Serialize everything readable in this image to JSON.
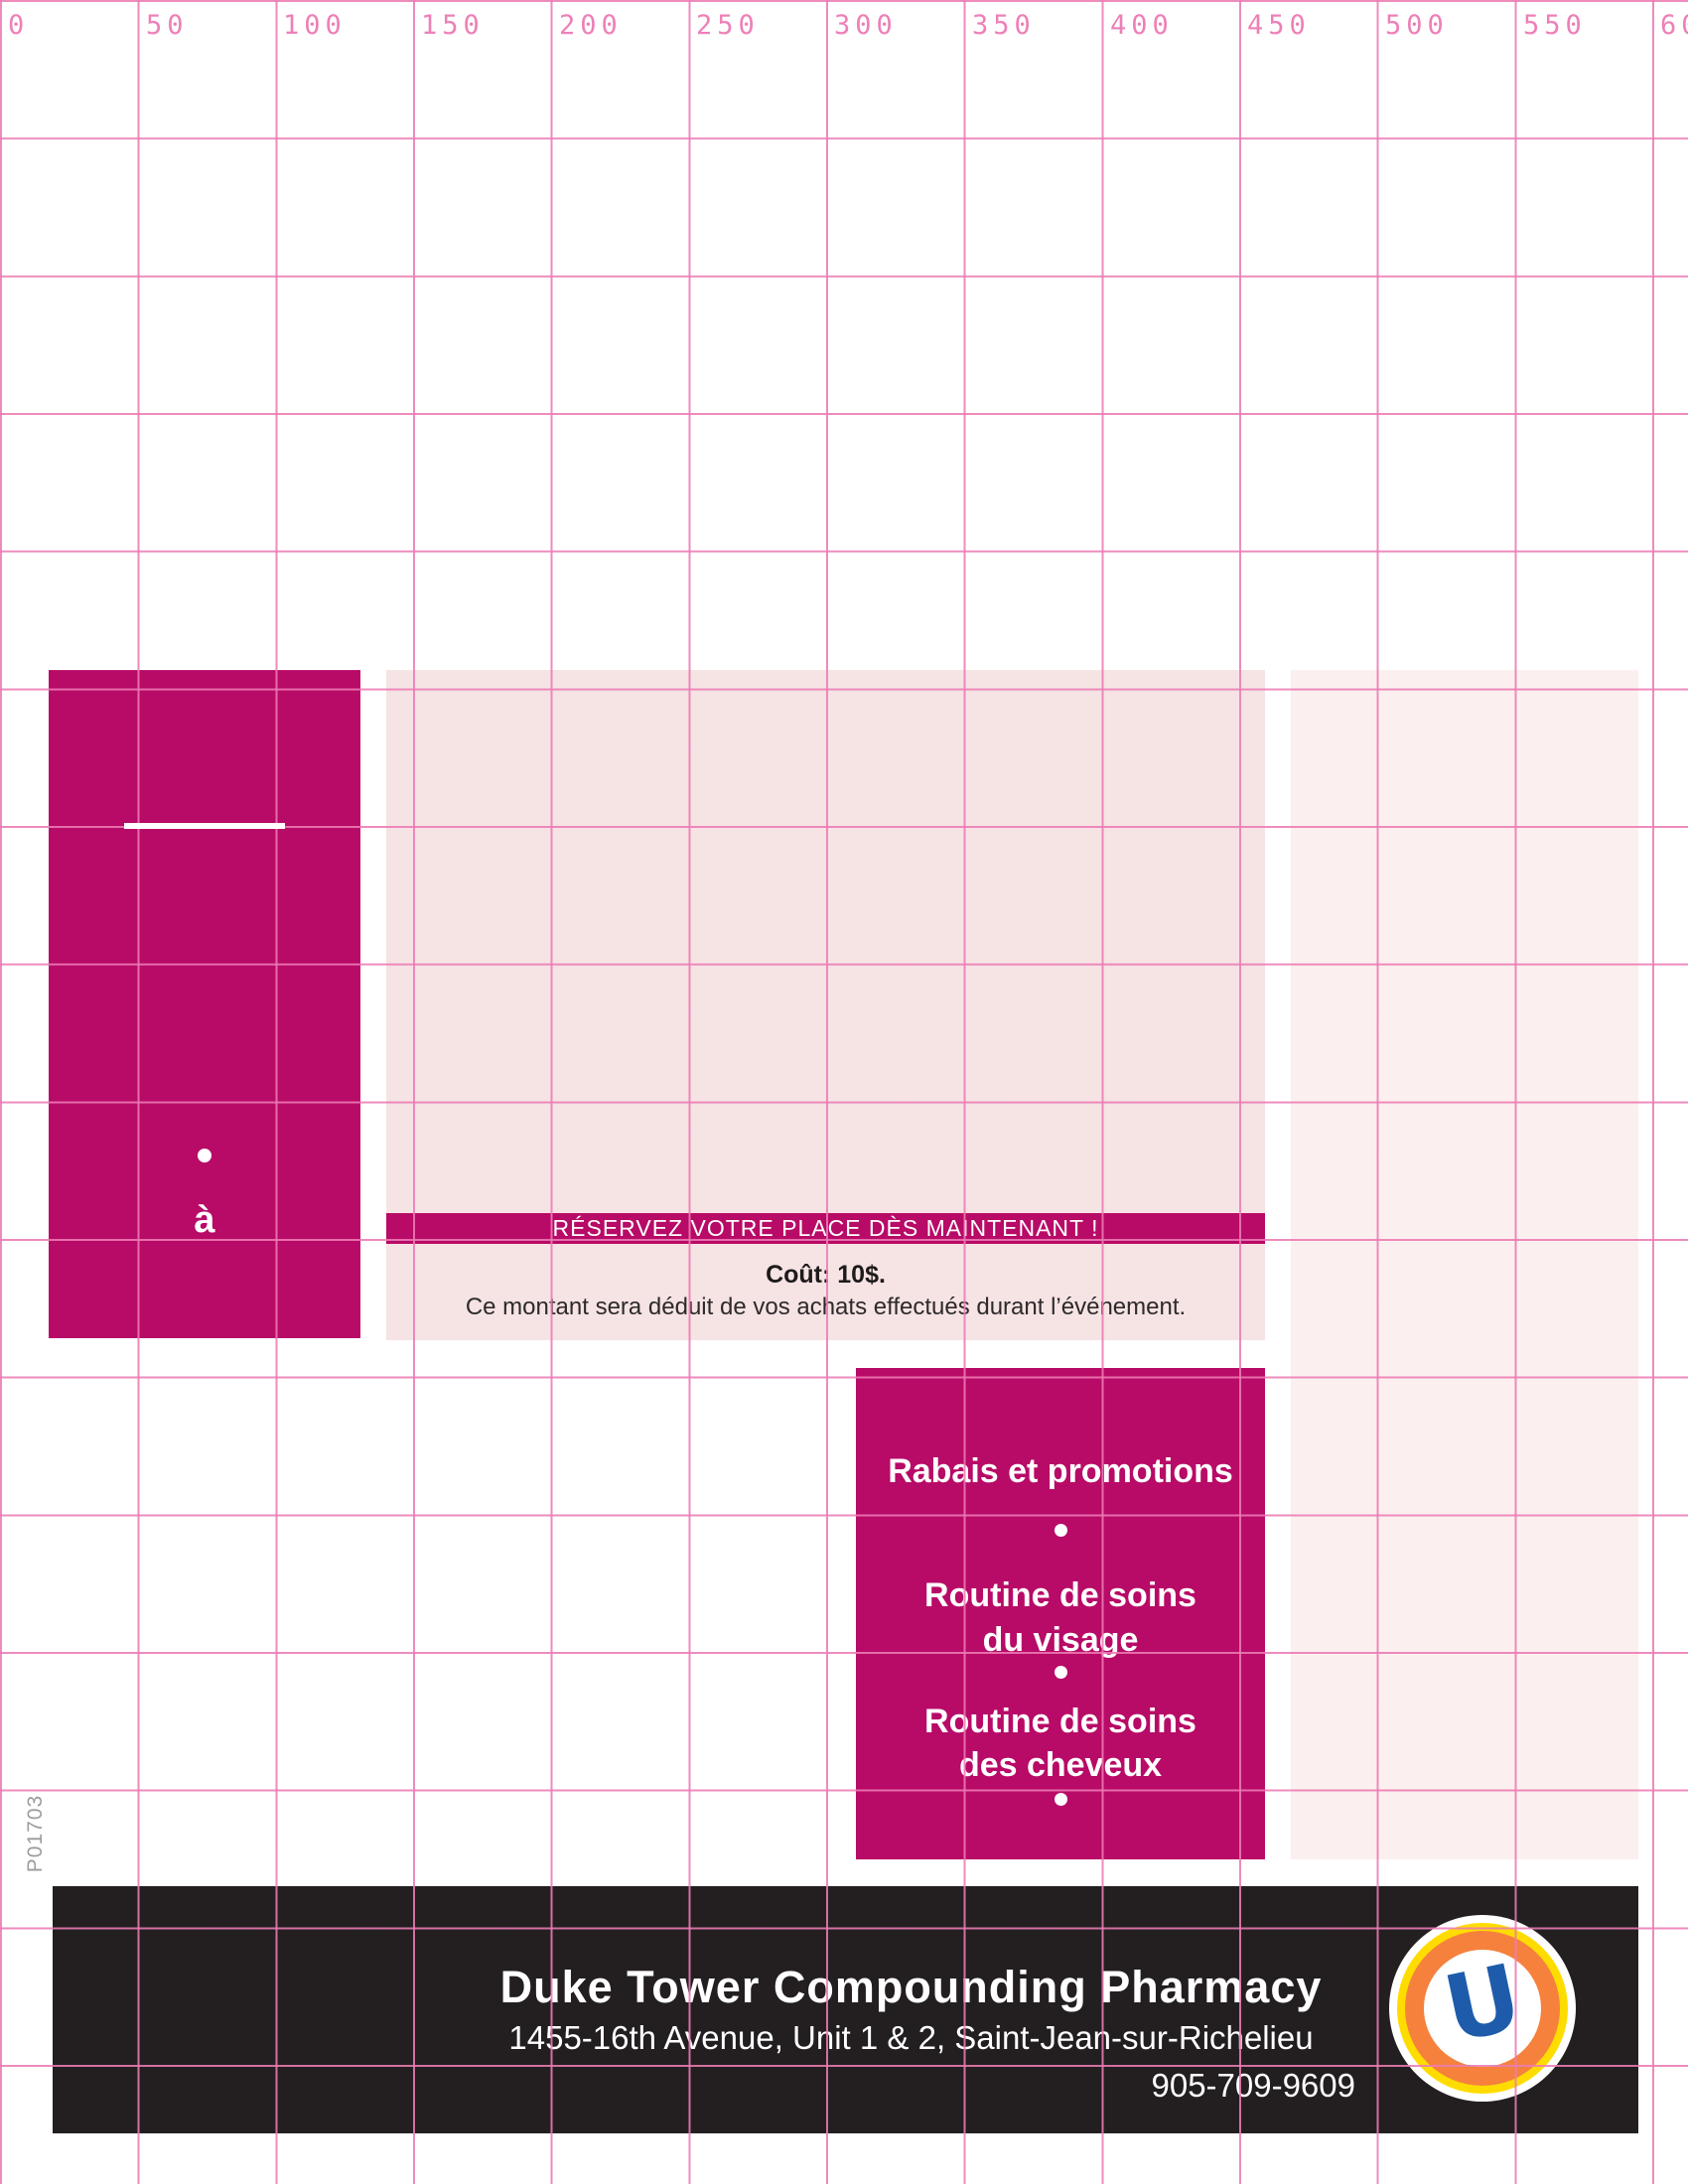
{
  "ruler": {
    "labels": [
      "0",
      "50",
      "100",
      "150",
      "200",
      "250",
      "300",
      "350",
      "400",
      "450",
      "500",
      "550",
      "600"
    ]
  },
  "plate_code": "P01703",
  "left_panel": {
    "bullet": "•",
    "word": "à"
  },
  "reservation": {
    "banner_text": "RÉSERVEZ VOTRE PLACE DÈS MAINTENANT !",
    "cost_title": "Coût: 10$.",
    "cost_note": "Ce montant sera déduit de vos achats effectués durant l’événement."
  },
  "topics": {
    "title": "Rabais et promotions",
    "bullet": "•",
    "face_line1": "Routine de soins",
    "face_line2": "du visage",
    "hair_line1": "Routine de soins",
    "hair_line2": "des cheveux"
  },
  "footer": {
    "pharmacy_name": "Duke Tower Compounding Pharmacy",
    "address": "1455-16th Avenue, Unit 1 & 2, Saint-Jean-sur-Richelieu",
    "phone": "905-709-9609",
    "logo_letter": "U"
  },
  "colors": {
    "magenta": "#b80a67",
    "panel_pink": "#f6e3e3",
    "column_pink": "#fbf0ef",
    "grid_pink": "#ed80b7",
    "footer_black": "#231f20",
    "logo_orange": "#f5813d",
    "logo_yellow": "#ffdc00",
    "logo_blue": "#1e5cab"
  }
}
